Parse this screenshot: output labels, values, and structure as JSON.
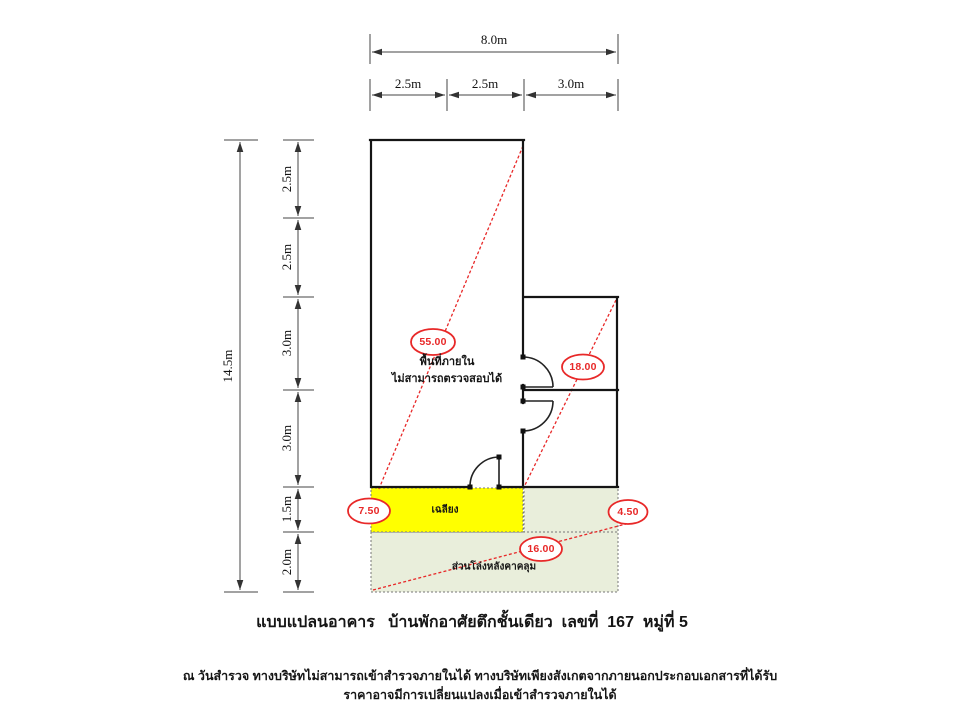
{
  "page": {
    "title": "แบบแปลนอาคาร   บ้านพักอาศัยตึกชั้นเดียว  เลขที่  167  หมู่ที่ 5",
    "disclaimer_line1": "ณ วันสำรวจ ทางบริษัทไม่สามารถเข้าสำรวจภายในได้ ทางบริษัทเพียงสังเกตจากภายนอกประกอบเอกสารที่ได้รับ",
    "disclaimer_line2": "ราคาอาจมีการเปลี่ยนแปลงเมื่อเข้าสำรวจภายในได้"
  },
  "dimensions": {
    "top": {
      "total": "8.0m",
      "segments": [
        "2.5m",
        "2.5m",
        "3.0m"
      ]
    },
    "left": {
      "total": "14.5m",
      "segments": [
        "2.5m",
        "2.5m",
        "3.0m",
        "3.0m",
        "1.5m",
        "2.0m"
      ]
    }
  },
  "areas": {
    "interior_main": "55.00",
    "interior_wing": "18.00",
    "porch": "7.50",
    "side_covered": "4.50",
    "rear_covered": "16.00"
  },
  "labels": {
    "interior_note_line1": "พื้นที่ภายใน",
    "interior_note_line2": "ไม่สามารถตรวจสอบได้",
    "porch": "เฉลียง",
    "rear_covered": "ส่วนโล่งหลังคาคลุม"
  },
  "colors": {
    "porch_fill": "#ffff00",
    "covered_fill": "#e9eedb",
    "accent_red": "#e82828",
    "wall": "#151515"
  }
}
